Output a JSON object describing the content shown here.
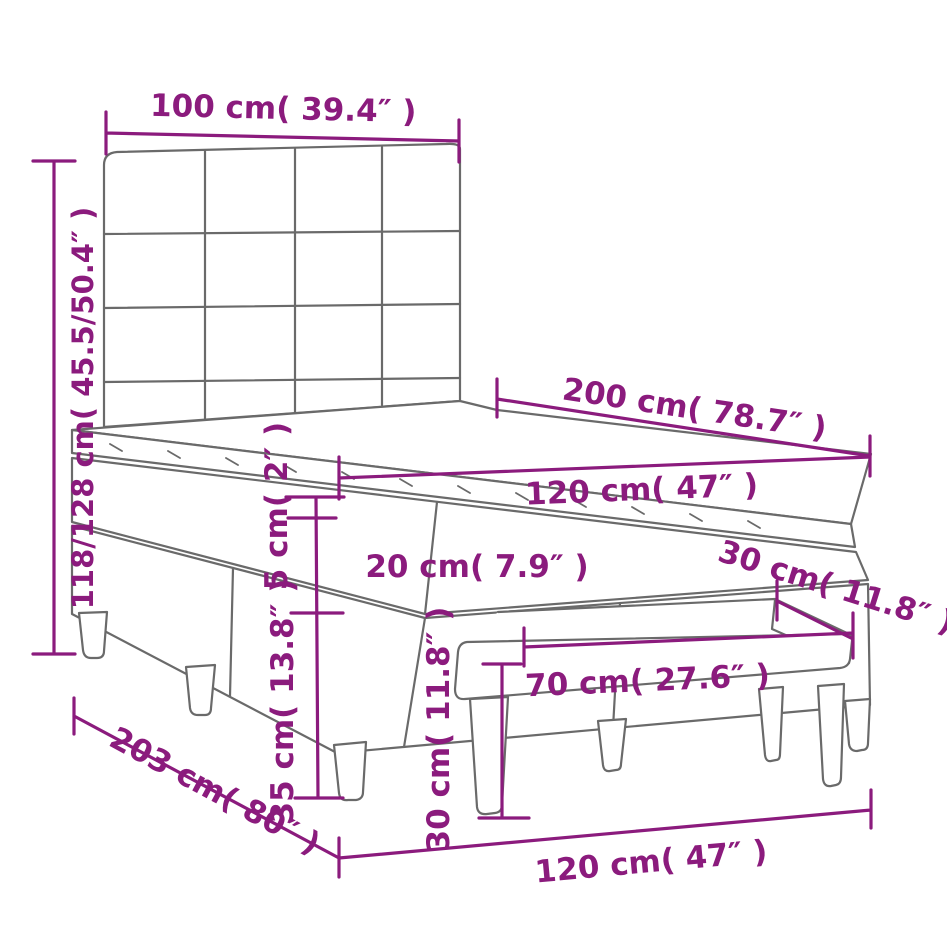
{
  "colors": {
    "background": "#ffffff",
    "line": "#6a6a6a",
    "accent": "#8b1b7d"
  },
  "diagram": {
    "type": "product-dimension-drawing",
    "subject": "box spring bed with tufted headboard, mattress topper and footstool bench",
    "labels": {
      "headboard_width": "100 cm( 39.4″ )",
      "overall_height": "118/128 cm( 45.5/50.4″ )",
      "bed_length": "200 cm( 78.7″ )",
      "mattress_width": "120 cm( 47″ )",
      "topper_thickness": "5 cm( 2″ )",
      "mattress_thickness": "20 cm( 7.9″ )",
      "base_height": "35 cm( 13.8″ )",
      "bench_height": "30 cm( 11.8″ )",
      "bench_length": "70 cm( 27.6″ )",
      "bench_depth": "30 cm( 11.8″ )",
      "frame_length": "203 cm( 80″ )",
      "frame_width": "120 cm( 47″ )"
    }
  }
}
